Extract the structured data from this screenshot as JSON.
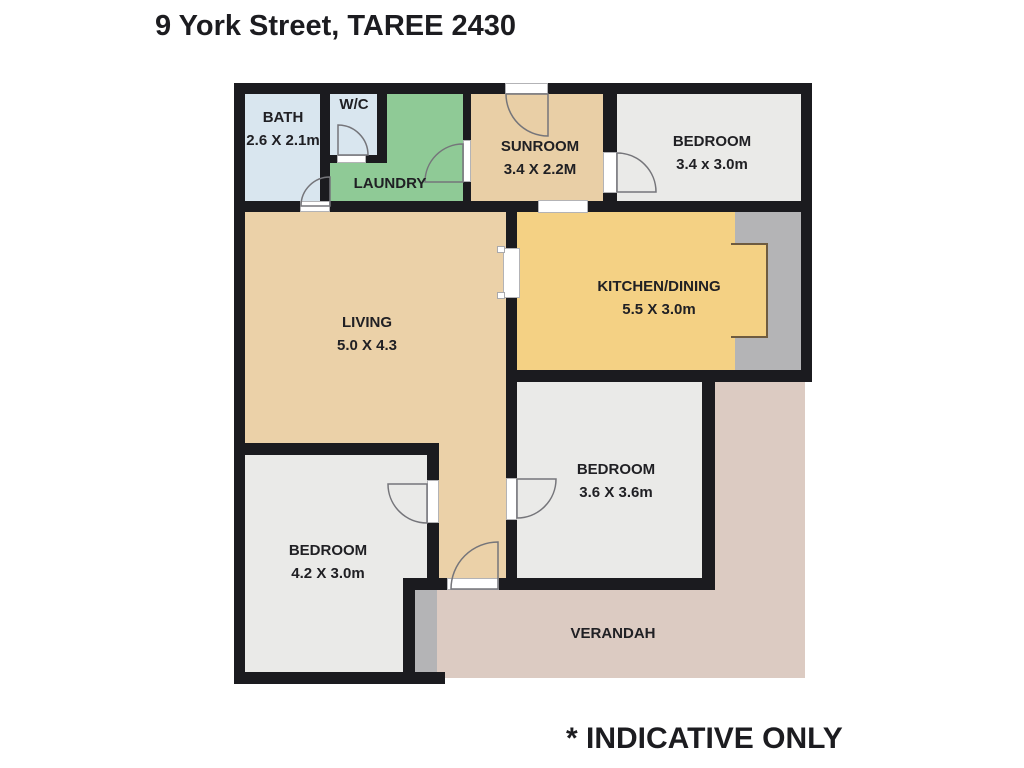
{
  "title": "9 York Street, TAREE 2430",
  "disclaimer": "* INDICATIVE ONLY",
  "colors": {
    "wall": "#1b1b1f",
    "bath": "#d9e6ef",
    "wc": "#d9e6ef",
    "laundry": "#8fca96",
    "sunroom": "#e9cfa6",
    "living": "#ebd1a8",
    "kitchen": "#f4d184",
    "bedroom": "#eaeae8",
    "verandah": "#dccbc2",
    "alcove": "#b4b4b6",
    "opening": "#ffffff"
  },
  "rooms": {
    "bath": {
      "name": "BATH",
      "dims": "2.6 X 2.1m"
    },
    "wc": {
      "name": "W/C",
      "dims": ""
    },
    "laundry": {
      "name": "LAUNDRY",
      "dims": ""
    },
    "sunroom": {
      "name": "SUNROOM",
      "dims": "3.4 X 2.2M"
    },
    "bedroom_top": {
      "name": "BEDROOM",
      "dims": "3.4 x 3.0m"
    },
    "kitchen": {
      "name": "KITCHEN/DINING",
      "dims": "5.5 X 3.0m"
    },
    "living": {
      "name": "LIVING",
      "dims": "5.0 X 4.3"
    },
    "bedroom_left": {
      "name": "BEDROOM",
      "dims": "4.2 X 3.0m"
    },
    "bedroom_right": {
      "name": "BEDROOM",
      "dims": "3.6 X 3.6m"
    },
    "verandah": {
      "name": "VERANDAH",
      "dims": ""
    }
  }
}
